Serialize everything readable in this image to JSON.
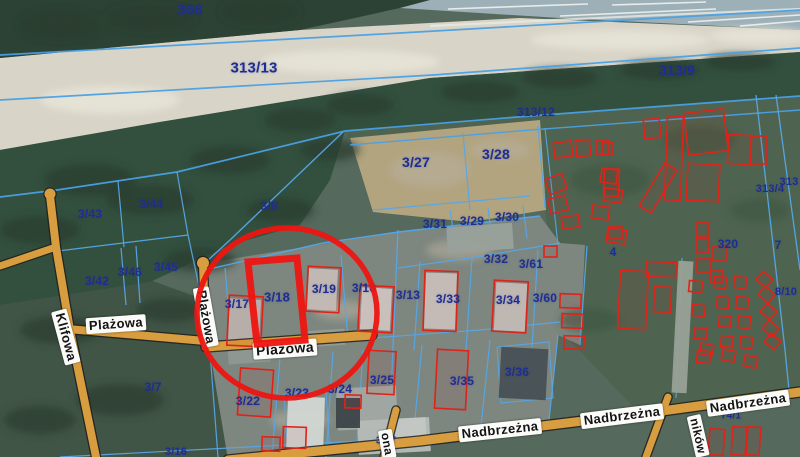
{
  "map": {
    "width": 800,
    "height": 457,
    "colors": {
      "label_blue": "#1f2d92",
      "parcel_line": "#56a7e8",
      "parcel_line_major": "#4aa0e4",
      "road_fill": "#d89d3e",
      "road_casing": "#1e1e1e",
      "building_red": "#e02318",
      "highlight_red": "#ee1511",
      "street_label_bg": "#fbfbf9",
      "street_label_text": "#131313"
    },
    "highlight": {
      "highlighted_parcel": "3/18",
      "circle": {
        "cx": 287,
        "cy": 313,
        "rx": 90,
        "ry": 85,
        "stroke_width": 5.5
      },
      "parcel_outline_points": "248,262 297,258 305,340 257,344",
      "parcel_outline_width": 7
    },
    "parcel_labels": [
      {
        "text": "366",
        "x": 190,
        "y": 10,
        "size": 15
      },
      {
        "text": "313/13",
        "x": 254,
        "y": 68,
        "size": 15
      },
      {
        "text": "313/9",
        "x": 677,
        "y": 70,
        "size": 14
      },
      {
        "text": "313/12",
        "x": 536,
        "y": 112,
        "size": 12
      },
      {
        "text": "3/27",
        "x": 416,
        "y": 162,
        "size": 14
      },
      {
        "text": "3/28",
        "x": 496,
        "y": 154,
        "size": 14
      },
      {
        "text": "3/8",
        "x": 269,
        "y": 206,
        "size": 12
      },
      {
        "text": "3/43",
        "x": 90,
        "y": 214,
        "size": 12
      },
      {
        "text": "3/44",
        "x": 151,
        "y": 204,
        "size": 12
      },
      {
        "text": "3/45",
        "x": 166,
        "y": 267,
        "size": 12
      },
      {
        "text": "3/46",
        "x": 130,
        "y": 272,
        "size": 12
      },
      {
        "text": "3/42",
        "x": 97,
        "y": 281,
        "size": 12
      },
      {
        "text": "3/31",
        "x": 435,
        "y": 224,
        "size": 12
      },
      {
        "text": "3/29",
        "x": 472,
        "y": 221,
        "size": 12
      },
      {
        "text": "3/30",
        "x": 507,
        "y": 217,
        "size": 12
      },
      {
        "text": "3/32",
        "x": 496,
        "y": 259,
        "size": 12
      },
      {
        "text": "3/61",
        "x": 531,
        "y": 264,
        "size": 12
      },
      {
        "text": "3/17",
        "x": 237,
        "y": 304,
        "size": 12
      },
      {
        "text": "3/18",
        "x": 277,
        "y": 297,
        "size": 13
      },
      {
        "text": "3/19",
        "x": 324,
        "y": 289,
        "size": 12
      },
      {
        "text": "3/10",
        "x": 364,
        "y": 288,
        "size": 12
      },
      {
        "text": "3/13",
        "x": 408,
        "y": 295,
        "size": 12
      },
      {
        "text": "3/33",
        "x": 448,
        "y": 299,
        "size": 12
      },
      {
        "text": "3/34",
        "x": 508,
        "y": 300,
        "size": 12
      },
      {
        "text": "3/60",
        "x": 545,
        "y": 298,
        "size": 12
      },
      {
        "text": "320",
        "x": 728,
        "y": 244,
        "size": 12
      },
      {
        "text": "4",
        "x": 613,
        "y": 252,
        "size": 12
      },
      {
        "text": "7",
        "x": 778,
        "y": 245,
        "size": 12
      },
      {
        "text": "313/4",
        "x": 770,
        "y": 189,
        "size": 11
      },
      {
        "text": "313",
        "x": 789,
        "y": 182,
        "size": 11
      },
      {
        "text": "8/10",
        "x": 786,
        "y": 292,
        "size": 11
      },
      {
        "text": "3/25",
        "x": 382,
        "y": 380,
        "size": 12
      },
      {
        "text": "3/35",
        "x": 462,
        "y": 381,
        "size": 12
      },
      {
        "text": "3/36",
        "x": 517,
        "y": 372,
        "size": 12
      },
      {
        "text": "3/22",
        "x": 248,
        "y": 401,
        "size": 12
      },
      {
        "text": "3/23",
        "x": 297,
        "y": 393,
        "size": 12
      },
      {
        "text": "3/24",
        "x": 340,
        "y": 389,
        "size": 12
      },
      {
        "text": "3/7",
        "x": 153,
        "y": 387,
        "size": 12
      },
      {
        "text": "3/16",
        "x": 176,
        "y": 452,
        "size": 11
      },
      {
        "text": "74/1",
        "x": 731,
        "y": 416,
        "size": 10
      },
      {
        "text": "34/7",
        "x": 386,
        "y": 441,
        "size": 10
      }
    ],
    "street_labels": [
      {
        "text": "Plażowa",
        "x": 116,
        "y": 324,
        "rot": -4,
        "size": 13
      },
      {
        "text": "Plażowa",
        "x": 206,
        "y": 317,
        "rot": 80,
        "size": 13
      },
      {
        "text": "Plażowa",
        "x": 285,
        "y": 349,
        "rot": -4,
        "size": 14
      },
      {
        "text": "Klifowa",
        "x": 66,
        "y": 337,
        "rot": 75,
        "size": 13
      },
      {
        "text": "Nadbrzeżna",
        "x": 500,
        "y": 430,
        "rot": -6,
        "size": 13
      },
      {
        "text": "Nadbrzeżna",
        "x": 622,
        "y": 416,
        "rot": -7,
        "size": 13
      },
      {
        "text": "Nadbrzeżna",
        "x": 748,
        "y": 403,
        "rot": -8,
        "size": 13
      },
      {
        "text": "ników",
        "x": 698,
        "y": 436,
        "rot": 77,
        "size": 12
      },
      {
        "text": "ona",
        "x": 387,
        "y": 444,
        "rot": 80,
        "size": 12
      }
    ],
    "geometry": {
      "terrain": [
        {
          "name": "base",
          "points": "0,0 800,0 800,457 0,457",
          "fill": "#55695c"
        },
        {
          "name": "right-grass",
          "points": "345,131 530,116 800,96 800,392 640,414 560,330 545,210 460,222 373,212 350,140",
          "fill": "#4e6450"
        },
        {
          "name": "center-developed",
          "points": "205,263 398,232 540,216 560,243 585,245 580,345 558,335 548,430 420,441 228,460 210,352 205,300",
          "fill": "#7d867f"
        },
        {
          "name": "left-field",
          "points": "0,305 150,280 205,300 210,352 228,460 0,457",
          "fill": "#415547"
        },
        {
          "name": "bare-ground",
          "points": "350,138 540,120 546,210 470,222 373,212",
          "fill": "#b2a47f"
        },
        {
          "name": "sea",
          "points": "400,0 800,0 800,30 560,18 400,8",
          "fill": "#9db0b8"
        },
        {
          "name": "beach",
          "points": "0,58 300,30 520,18 800,30 800,52 430,78 160,122 0,150",
          "fill": "#d8d4c7"
        },
        {
          "name": "top-forest",
          "points": "0,0 430,0 400,8 300,30 0,58",
          "fill": "#2c4234"
        },
        {
          "name": "forest-band",
          "points": "0,150 160,122 430,78 800,52 800,96 620,110 530,116 345,131 330,180 300,225 230,245 150,282 0,305",
          "fill": "#33503f"
        }
      ],
      "parcel_lines": [
        {
          "pts": "0,55 400,33 800,10",
          "w": 1.7,
          "major": true
        },
        {
          "pts": "0,100 433,75 800,48",
          "w": 1.7,
          "major": true
        },
        {
          "pts": "0,197 57,190 177,172 345,131 530,116 800,96",
          "w": 1.7,
          "major": true
        },
        {
          "pts": "350,145 530,130 800,110",
          "w": 1.4,
          "major": true
        },
        {
          "pts": "118,181 124,247",
          "w": 1.2
        },
        {
          "pts": "58,251 188,235",
          "w": 1.2
        },
        {
          "pts": "177,172 188,235 202,300",
          "w": 1.2
        },
        {
          "pts": "121,248 126,305",
          "w": 1.2
        },
        {
          "pts": "136,246 140,303",
          "w": 1.2
        },
        {
          "pts": "343,132 230,240 205,263",
          "w": 1.4
        },
        {
          "pts": "205,270 323,243 398,232 540,216",
          "w": 1.4
        },
        {
          "pts": "463,133 470,210",
          "w": 1.2
        },
        {
          "pts": "538,126 545,208",
          "w": 1.2
        },
        {
          "pts": "373,210 530,196",
          "w": 1.2
        },
        {
          "pts": "450,210 455,242",
          "w": 1.2
        },
        {
          "pts": "488,208 492,240",
          "w": 1.2
        },
        {
          "pts": "523,205 527,238",
          "w": 1.2
        },
        {
          "pts": "398,230 390,418",
          "w": 1.3
        },
        {
          "pts": "398,268 470,258 560,243",
          "w": 1.2
        },
        {
          "pts": "420,262 414,350",
          "w": 1.2
        },
        {
          "pts": "472,258 466,350",
          "w": 1.2
        },
        {
          "pts": "538,250 532,347",
          "w": 1.2
        },
        {
          "pts": "587,246 580,345",
          "w": 1.2
        },
        {
          "pts": "372,338 480,330 560,322",
          "w": 1.2
        },
        {
          "pts": "280,358 272,457",
          "w": 1.2
        },
        {
          "pts": "333,352 326,457",
          "w": 1.2
        },
        {
          "pts": "363,350 357,442",
          "w": 1.2
        },
        {
          "pts": "422,345 413,440",
          "w": 1.2
        },
        {
          "pts": "490,340 480,436",
          "w": 1.2
        },
        {
          "pts": "558,335 548,430",
          "w": 1.2
        },
        {
          "pts": "60,457 360,441",
          "w": 1.2
        },
        {
          "pts": "210,352 218,457",
          "w": 1.2
        },
        {
          "pts": "756,95 785,350 790,400",
          "w": 1.3
        },
        {
          "pts": "776,95 800,270",
          "w": 1.3
        },
        {
          "pts": "545,128 558,245",
          "w": 1.1
        },
        {
          "pts": "284,394 326,391 330,455 288,457 284,394",
          "w": 1.1
        },
        {
          "pts": "497,347 549,342 553,398 501,403 497,347",
          "w": 1.1
        },
        {
          "pts": "225,268 232,352",
          "w": 1.2
        },
        {
          "pts": "341,255 348,340",
          "w": 1.2
        },
        {
          "pts": "682,258 676,398",
          "w": 1.1
        }
      ],
      "roads": [
        {
          "name": "klifowa",
          "pts": "50,196 56,247 70,330 96,457",
          "w": 8
        },
        {
          "name": "klifowa-spur",
          "pts": "56,247 0,266",
          "w": 7
        },
        {
          "name": "plazowa-west",
          "pts": "68,329 205,341",
          "w": 8
        },
        {
          "name": "plazowa-stub",
          "pts": "203,265 206,345",
          "w": 8
        },
        {
          "name": "plazowa-east",
          "pts": "206,347 372,335",
          "w": 9
        },
        {
          "name": "nadbrzezna",
          "pts": "228,460 420,441 640,414 800,392",
          "w": 9
        },
        {
          "name": "ona-street",
          "pts": "396,410 384,457",
          "w": 7
        },
        {
          "name": "nikow-street",
          "pts": "668,397 646,457",
          "w": 7
        }
      ],
      "road_bulbs": [
        {
          "cx": 50,
          "cy": 194,
          "r": 5.5
        },
        {
          "cx": 203,
          "cy": 263,
          "r": 6
        }
      ],
      "buildings_red": [
        [
          228,
          296,
          34,
          50,
          3
        ],
        [
          307,
          267,
          33,
          45,
          3
        ],
        [
          359,
          286,
          34,
          46,
          3
        ],
        [
          424,
          271,
          33,
          60,
          2
        ],
        [
          493,
          281,
          34,
          51,
          3
        ],
        [
          560,
          294,
          21,
          14,
          2
        ],
        [
          562,
          314,
          21,
          14,
          2
        ],
        [
          564,
          336,
          20,
          13,
          2
        ],
        [
          368,
          351,
          27,
          43,
          3
        ],
        [
          436,
          350,
          31,
          59,
          3
        ],
        [
          239,
          369,
          33,
          47,
          4
        ],
        [
          283,
          427,
          23,
          21,
          2
        ],
        [
          345,
          395,
          16,
          13,
          2
        ],
        [
          666,
          116,
          16,
          84,
          2
        ],
        [
          686,
          111,
          40,
          42,
          -7
        ],
        [
          728,
          135,
          23,
          29,
          3
        ],
        [
          751,
          136,
          16,
          28,
          0
        ],
        [
          651,
          163,
          14,
          50,
          31
        ],
        [
          687,
          164,
          32,
          37,
          3
        ],
        [
          602,
          142,
          11,
          13,
          0
        ],
        [
          604,
          169,
          15,
          27,
          2
        ],
        [
          609,
          226,
          13,
          13,
          0
        ],
        [
          696,
          222,
          13,
          14,
          0
        ],
        [
          696,
          238,
          13,
          15,
          0
        ],
        [
          712,
          247,
          14,
          13,
          0
        ],
        [
          697,
          259,
          13,
          13,
          0
        ],
        [
          710,
          270,
          13,
          12,
          0
        ],
        [
          554,
          142,
          18,
          15,
          -8
        ],
        [
          576,
          140,
          14,
          16,
          -5
        ],
        [
          596,
          140,
          13,
          15,
          0
        ],
        [
          547,
          176,
          18,
          16,
          -20
        ],
        [
          549,
          197,
          18,
          15,
          -15
        ],
        [
          601,
          169,
          16,
          14,
          8
        ],
        [
          604,
          189,
          18,
          13,
          8
        ],
        [
          592,
          206,
          17,
          13,
          8
        ],
        [
          562,
          216,
          17,
          12,
          -10
        ],
        [
          607,
          229,
          19,
          14,
          8
        ],
        [
          644,
          119,
          16,
          19,
          -5
        ],
        [
          544,
          246,
          13,
          11,
          0
        ],
        [
          619,
          271,
          28,
          58,
          3
        ],
        [
          646,
          262,
          30,
          15,
          2
        ],
        [
          654,
          287,
          17,
          25,
          2
        ],
        [
          689,
          281,
          13,
          11,
          5
        ],
        [
          692,
          305,
          13,
          11,
          5
        ],
        [
          694,
          328,
          13,
          11,
          5
        ],
        [
          697,
          351,
          13,
          12,
          5
        ],
        [
          714,
          277,
          12,
          11,
          5
        ],
        [
          717,
          297,
          12,
          11,
          5
        ],
        [
          719,
          316,
          12,
          11,
          5
        ],
        [
          721,
          336,
          12,
          11,
          5
        ],
        [
          734,
          277,
          12,
          11,
          5
        ],
        [
          736,
          297,
          12,
          12,
          5
        ],
        [
          738,
          316,
          12,
          12,
          5
        ],
        [
          740,
          337,
          12,
          11,
          5
        ],
        [
          758,
          274,
          13,
          11,
          40
        ],
        [
          760,
          289,
          13,
          11,
          40
        ],
        [
          762,
          306,
          13,
          11,
          40
        ],
        [
          764,
          323,
          13,
          11,
          40
        ],
        [
          766,
          336,
          13,
          11,
          40
        ],
        [
          700,
          344,
          13,
          11,
          12
        ],
        [
          722,
          350,
          13,
          11,
          12
        ],
        [
          744,
          356,
          13,
          11,
          12
        ],
        [
          709,
          429,
          15,
          26,
          4
        ],
        [
          732,
          427,
          14,
          28,
          4
        ],
        [
          747,
          427,
          13,
          28,
          4
        ],
        [
          262,
          437,
          18,
          14,
          2
        ]
      ],
      "buildings_gray": [
        [
          229,
          299,
          31,
          45,
          3,
          "#b7bdb8"
        ],
        [
          308,
          269,
          29,
          41,
          3,
          "#c2c7c3"
        ],
        [
          361,
          288,
          30,
          42,
          3,
          "#ccd0cc"
        ],
        [
          425,
          273,
          31,
          56,
          2,
          "#c6cbc7"
        ],
        [
          495,
          283,
          31,
          48,
          3,
          "#c1c6c2"
        ],
        [
          287,
          397,
          37,
          57,
          2,
          "#d2d7d4"
        ],
        [
          500,
          348,
          47,
          51,
          3,
          "#475056"
        ],
        [
          447,
          225,
          66,
          26,
          -4,
          "#99a19b"
        ],
        [
          337,
          387,
          60,
          42,
          -3,
          "#a2a8a3"
        ],
        [
          358,
          419,
          72,
          34,
          -3,
          "#b6bcb7"
        ],
        [
          675,
          261,
          15,
          132,
          3,
          "#99a197"
        ],
        [
          228,
          345,
          42,
          18,
          -4,
          "#8f9892"
        ],
        [
          305,
          330,
          40,
          16,
          -4,
          "#949c96"
        ],
        [
          390,
          418,
          36,
          26,
          -3,
          "#c3c8c4"
        ],
        [
          336,
          398,
          24,
          30,
          0,
          "#3d4549"
        ]
      ],
      "waves": [
        [
          448,
          9,
          588,
          4
        ],
        [
          560,
          16,
          716,
          9
        ],
        [
          688,
          22,
          800,
          15
        ],
        [
          612,
          5,
          706,
          2
        ],
        [
          740,
          26,
          800,
          21
        ]
      ],
      "shoreline": "430,26 640,16 800,9"
    }
  }
}
